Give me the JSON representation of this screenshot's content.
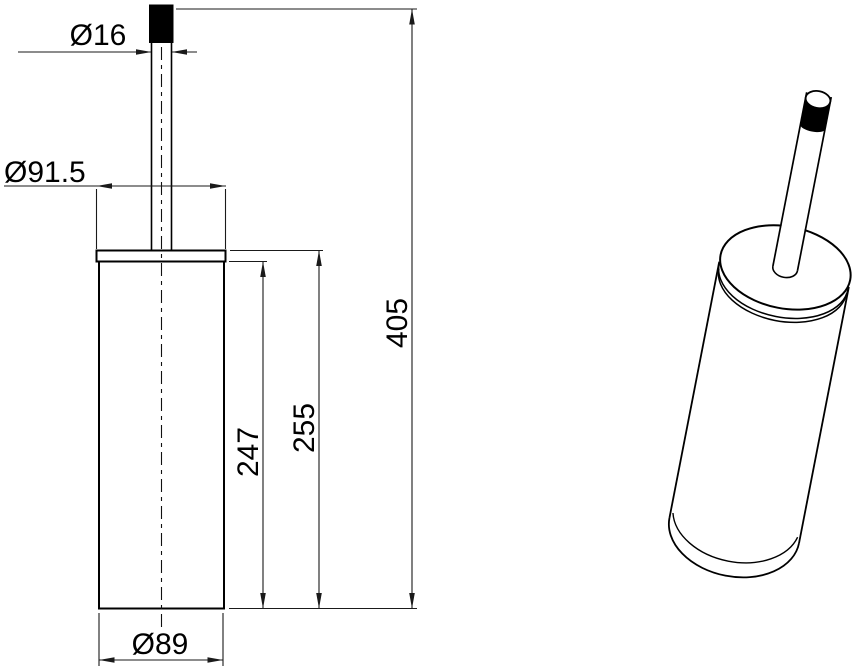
{
  "drawing": {
    "front_view": {
      "handle_diameter": "Ø16",
      "lid_diameter": "Ø91.5",
      "overall_height": "405",
      "lid_to_base_height": "255",
      "body_height": "247",
      "base_diameter": "Ø89"
    },
    "colors": {
      "object_line": "#000000",
      "dimension_line": "#1a1a1a",
      "background": "#ffffff"
    }
  }
}
